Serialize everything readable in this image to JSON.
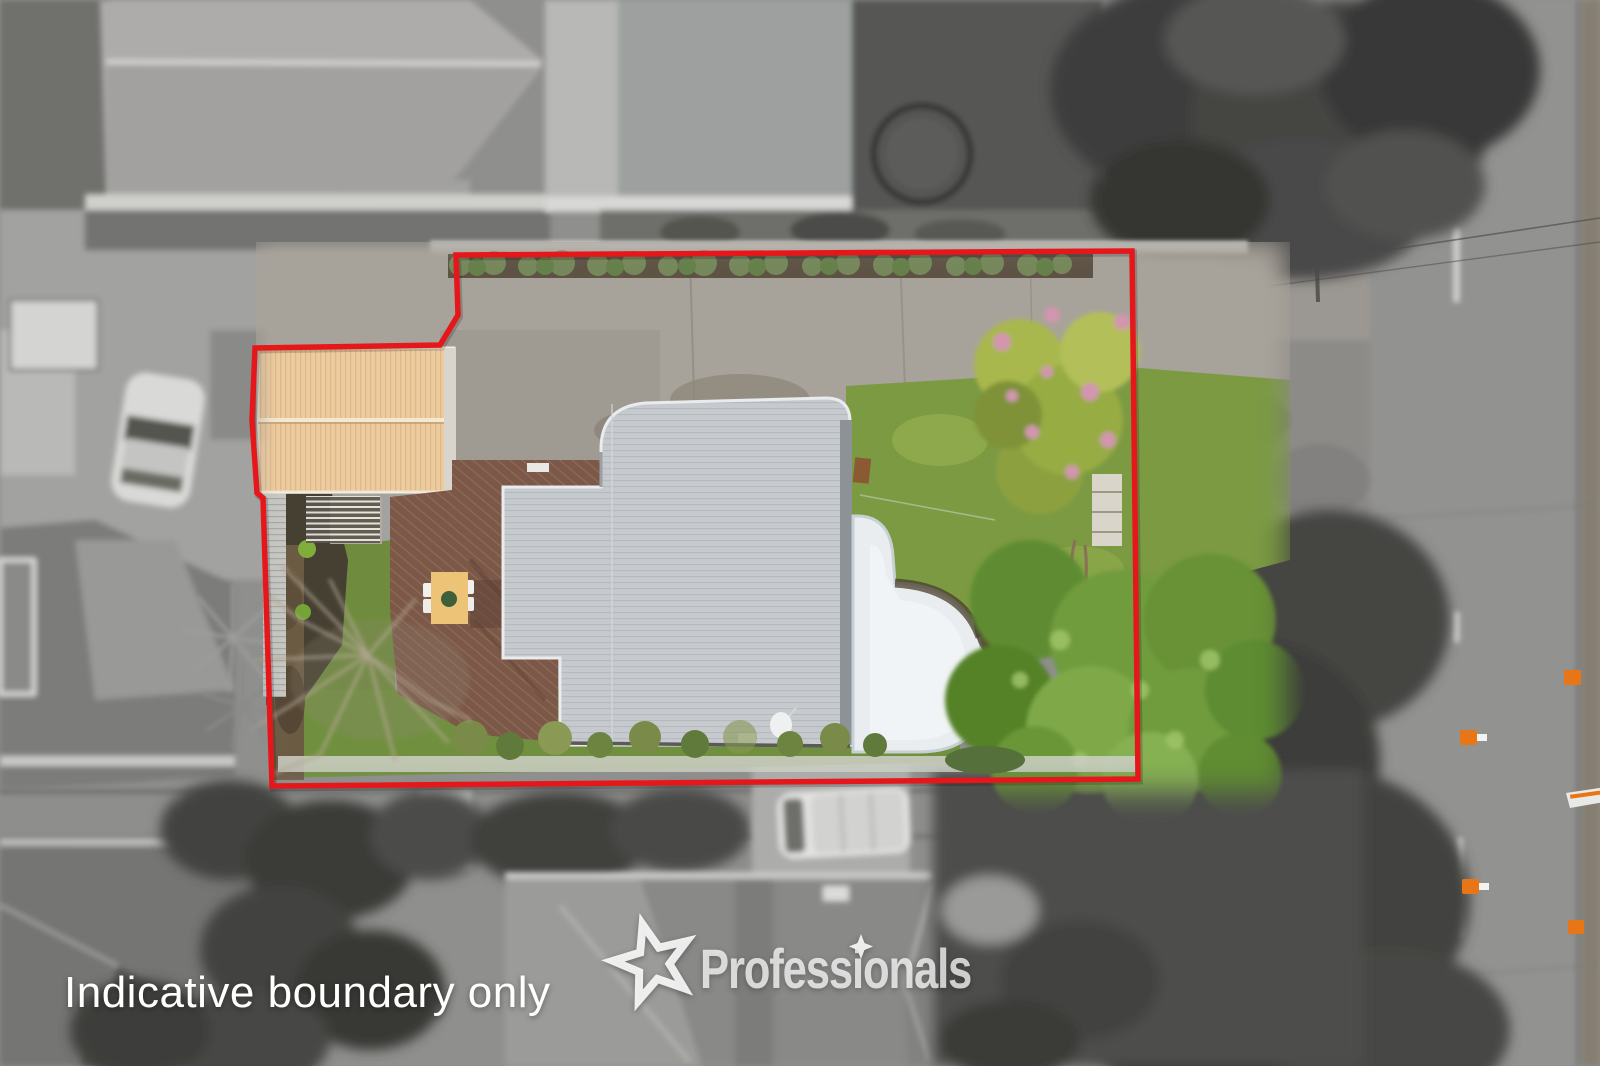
{
  "image": {
    "kind": "real-estate aerial drone photo",
    "description": "Top-down aerial of a residential property; lot highlighted in colour inside a red indicative boundary, surroundings desaturated grey"
  },
  "watermark": {
    "note": "Indicative boundary only",
    "brand": "Professionals"
  },
  "colors": {
    "boundary_red": "#e6171a",
    "watermark_white": "#ffffff",
    "shed_roof_tan": "#eccb9e",
    "house_roof_gray": "#c6cacd",
    "lawn_green": "#7b9a42",
    "tree_green": "#6f9c3e",
    "deck_brown": "#7b5848",
    "pool_white": "#e9edef",
    "cone_orange": "#e87616"
  }
}
